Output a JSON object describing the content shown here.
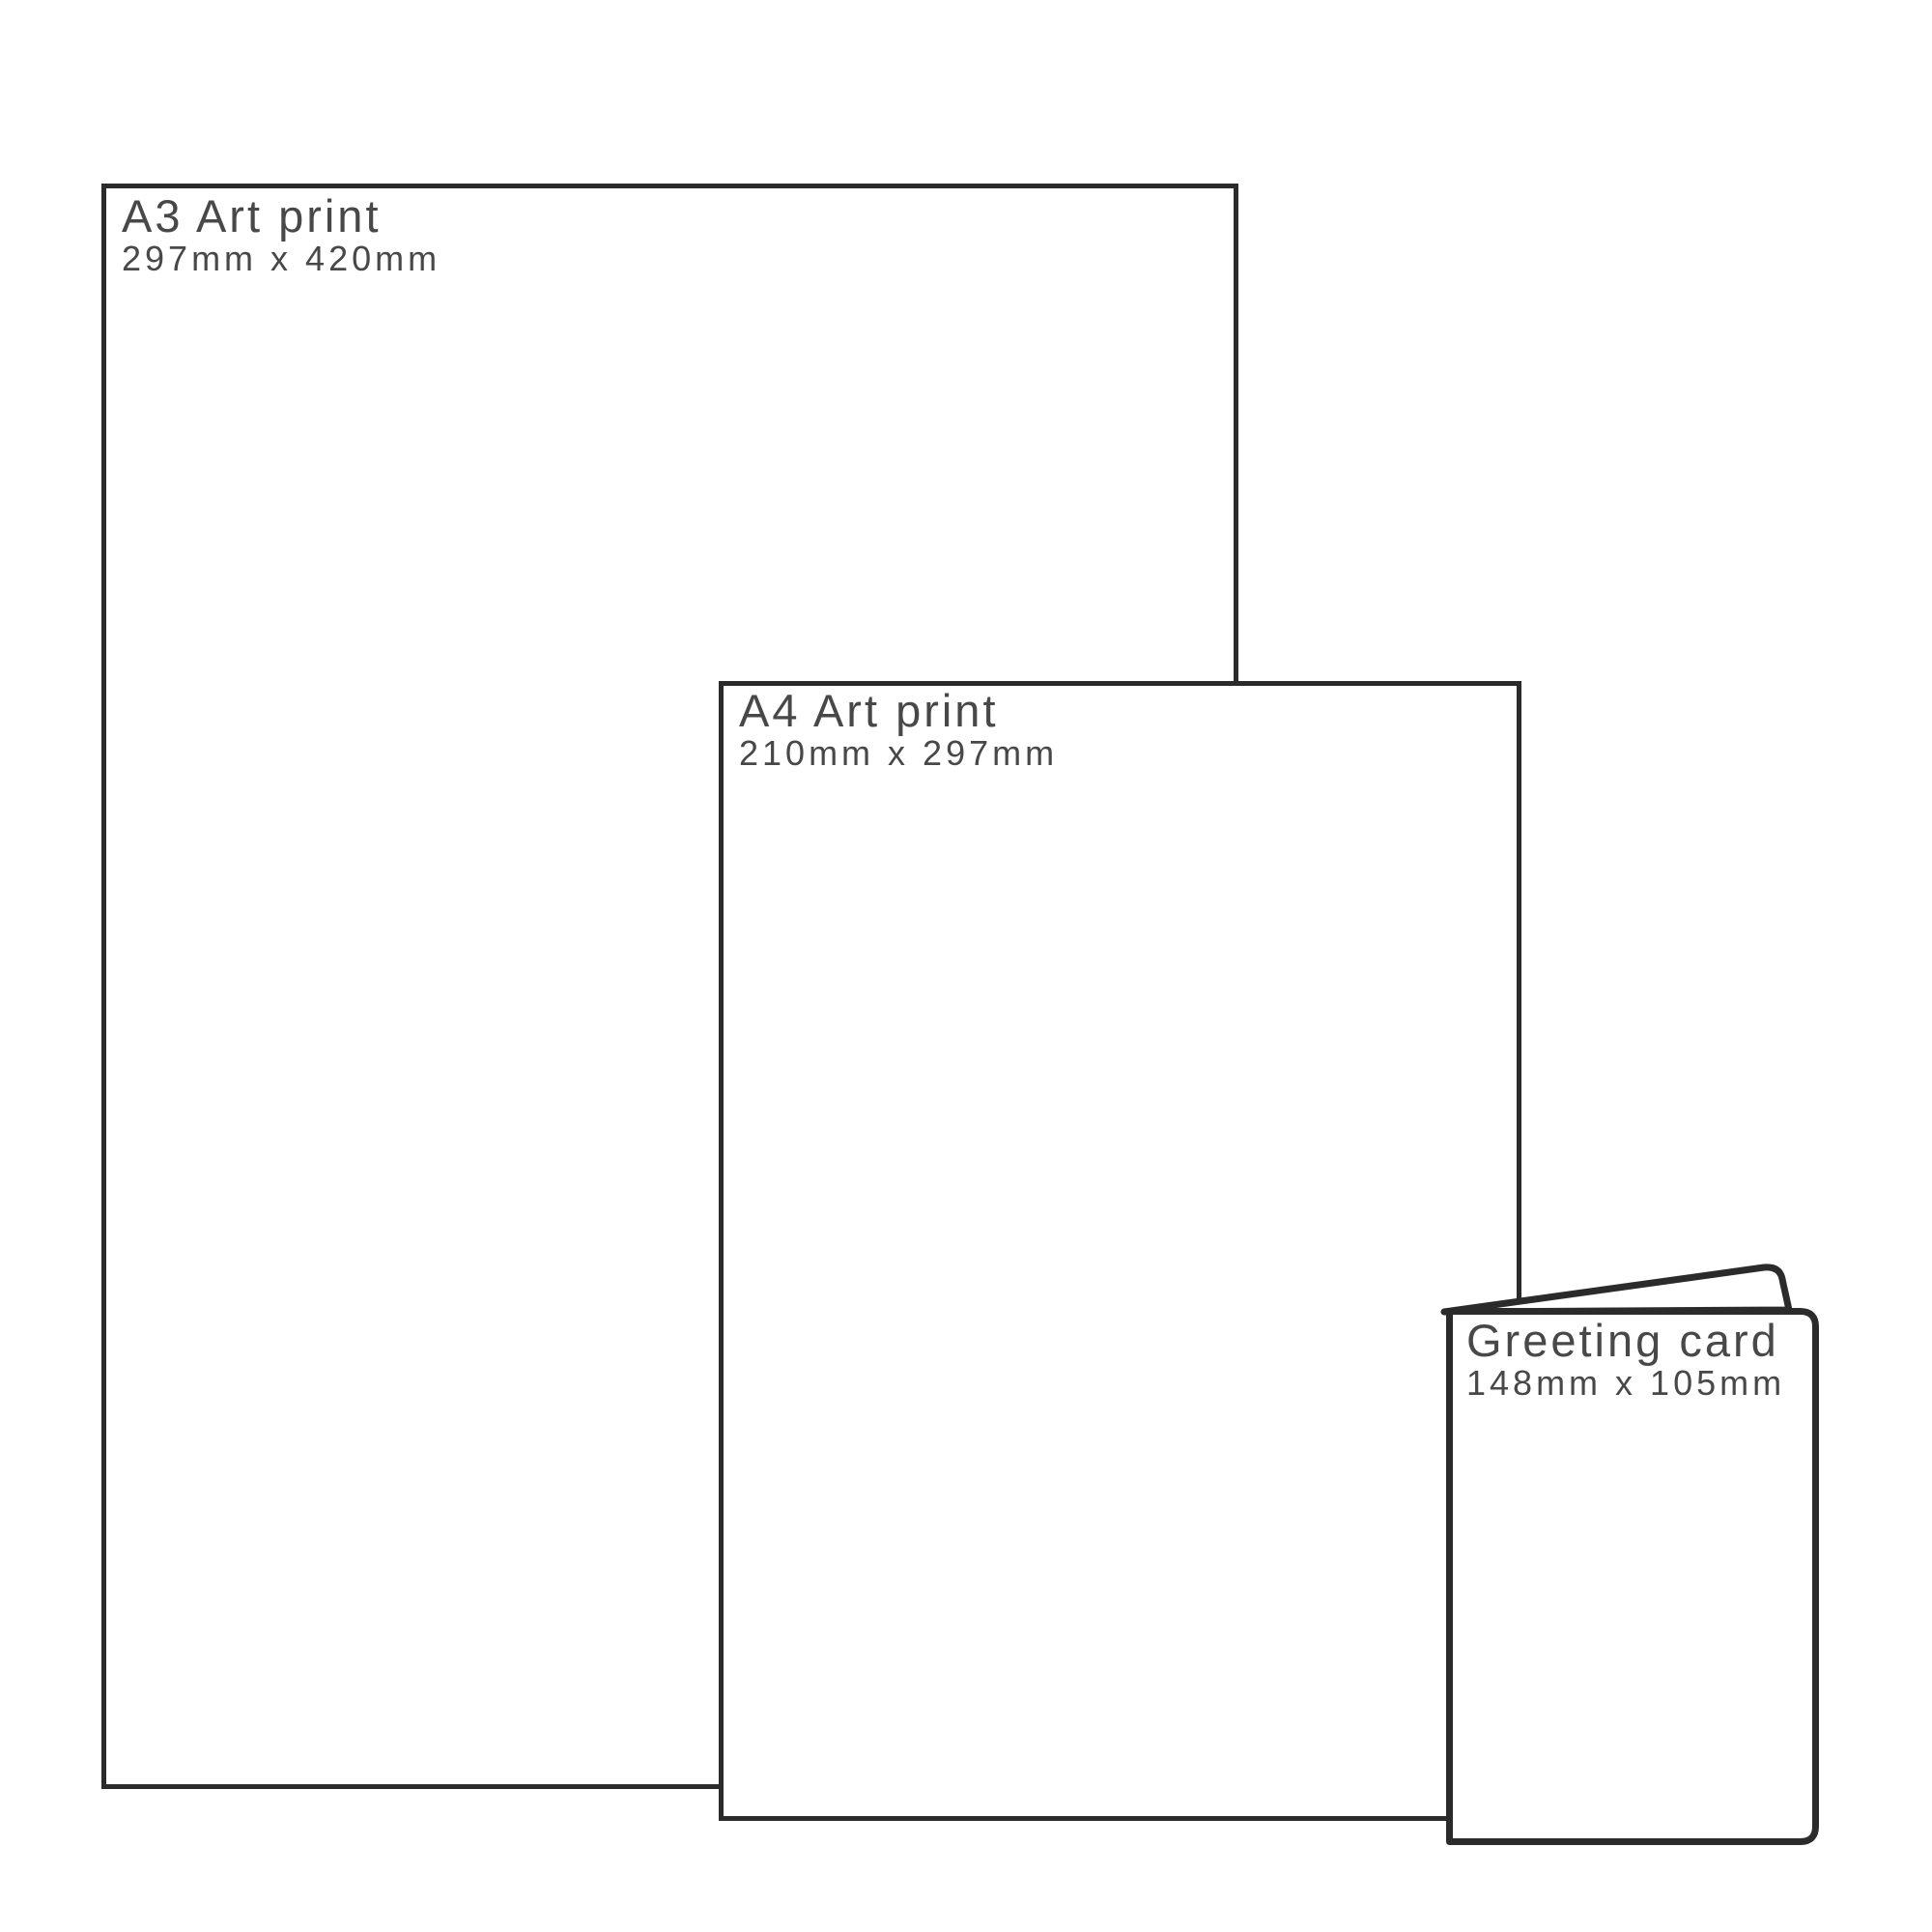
{
  "diagram": {
    "kind": "print-size-comparison"
  },
  "items": [
    {
      "id": "a3-print",
      "label": "A3 Art print",
      "dimensions": "297mm x 420mm"
    },
    {
      "id": "a4-print",
      "label": "A4 Art print",
      "dimensions": "210mm x 297mm"
    },
    {
      "id": "greeting-card",
      "label": "Greeting card",
      "dimensions": "148mm x 105mm"
    }
  ],
  "colors": {
    "outline": "#2b2b2b",
    "text": "#484848",
    "background": "#ffffff"
  }
}
